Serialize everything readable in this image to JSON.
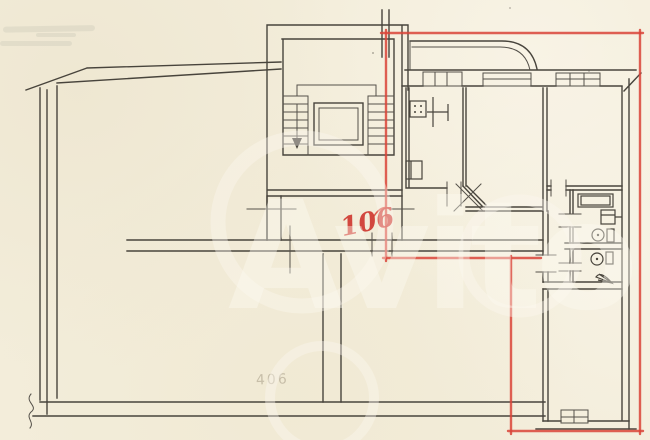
{
  "document": {
    "type_label": "scanned apartment floor plan",
    "apartment_number": "106",
    "faint_number": "406",
    "watermark_text": "Avito"
  },
  "colors": {
    "paper": "#f3edda",
    "ink": "#48443c",
    "marker_red": "#d94438",
    "watermark_white": "rgba(253,250,241,0.45)",
    "pencil_faint": "rgba(120,108,85,0.35)"
  },
  "symbols": {
    "stairs": "stairwell with two flights and down arrow",
    "elevator": "elevator shaft",
    "stove": "kitchen stove with four burners",
    "kitchen_sink": "kitchen sink",
    "vent": "ventilation shaft",
    "bathtub": "bathtub",
    "washbasin": "washbasin",
    "toilet": "toilet bowl with cistern",
    "window": "window symbol in exterior wall",
    "balcony": "balcony with rounded corner",
    "door": "door opening tick marks",
    "red_outline": "boundary of apartment 106 drawn in red marker",
    "break_mark": "paper/wall break squiggle"
  }
}
